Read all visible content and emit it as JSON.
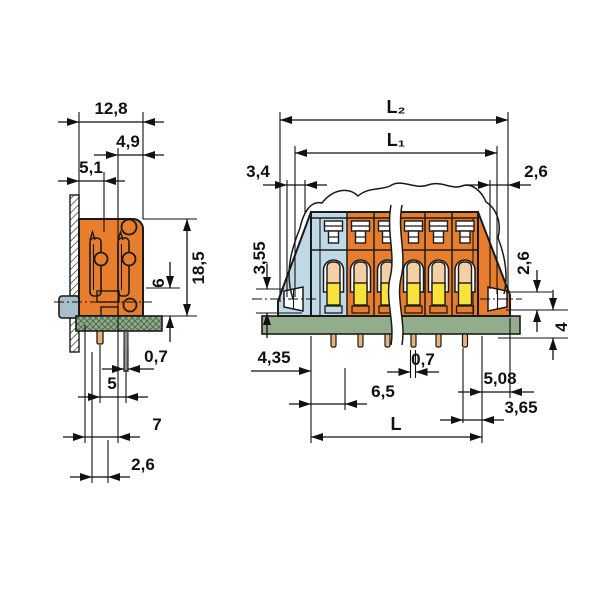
{
  "drawing": {
    "type": "technical-dimension-drawing",
    "subject": "PCB screw-less terminal block – side view and front view with dimensions (mm)",
    "colors": {
      "housing_orange": "#E87E2D",
      "first_pole_blue": "#BFD9E6",
      "pcb_green": "#92AC8C",
      "wire_port_yellow": "#F8E23B",
      "funnel_tan": "#F3CFA5",
      "pin_copper": "#E9B375",
      "solder_lug_gray": "#A9BECB"
    },
    "side_view": {
      "labels": {
        "total_width": "12,8",
        "upper_width": "4,9",
        "lower_width": "5,1",
        "height_above_pcb": "18,5",
        "height_6": "6",
        "pin_width": "0,7",
        "pin_pitch": "5",
        "depth_7": "7",
        "offset_26": "2,6"
      }
    },
    "front_view": {
      "labels": {
        "length_outer": "L₂",
        "length_inner": "L₁",
        "end_offset_left": "3,4",
        "end_offset_right": "2,6",
        "lug_height_left": "3,55",
        "lug_height_right": "2,6",
        "pin_protrusion": "4",
        "edge_to_pin": "4,35",
        "pin_group_span": "6,5",
        "pin_width": "0,7",
        "end_span_right": "5,08",
        "last_pin_to_edge": "3,65",
        "length_base": "L"
      }
    }
  }
}
